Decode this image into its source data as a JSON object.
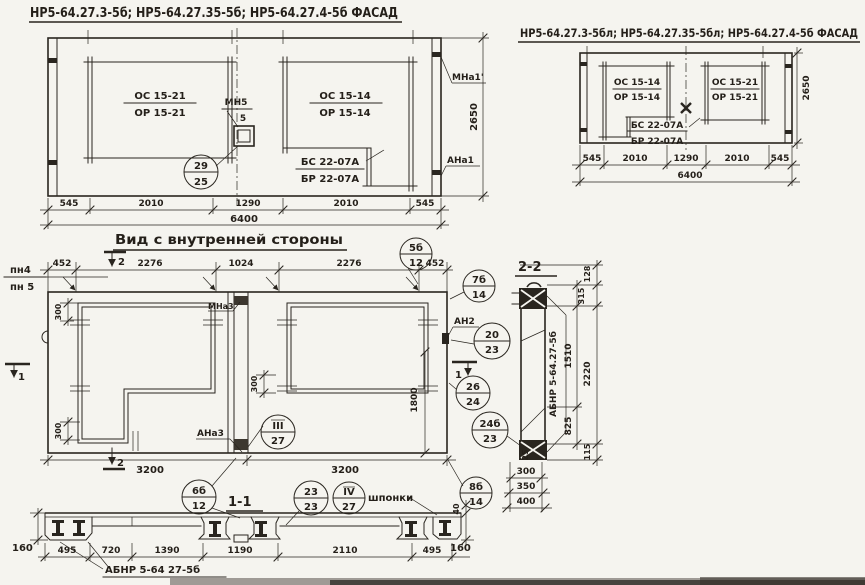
{
  "paper": {
    "bg": "#f5f4ef",
    "ink": "#29251f"
  },
  "facade_left": {
    "title": "НР5-64.27.3-5б; НР5-64.27.35-5б; НР5-64.27.4-5б   ФАСАД",
    "win_left": {
      "num": "ОС 15-21",
      "den": "ОР 15-21"
    },
    "win_right": {
      "num": "ОС 15-14",
      "den": "ОР 15-14"
    },
    "mid": {
      "num": "МН5",
      "den": "5"
    },
    "beam": {
      "num": "БС 22-07А",
      "den": "БР 22-07А"
    },
    "callout": {
      "num": "29",
      "den": "25"
    },
    "lbl_mna1": "МНа1'",
    "lbl_ana1": "АНа1",
    "dim_height": "2650",
    "dims": [
      "545",
      "2010",
      "1290",
      "2010",
      "545"
    ],
    "dim_total": "6400"
  },
  "facade_right": {
    "title": "НР5-64.27.3-5бл; НР5-64.27.35-5бл; НР5-64.27.4-5б ФАСАД",
    "win_left": {
      "num": "ОС 15-14",
      "den": "ОР 15-14"
    },
    "win_right": {
      "num": "ОС 15-21",
      "den": "ОР 15-21"
    },
    "beam": {
      "num": "БС 22-07А",
      "den": "БР 22-07А"
    },
    "dim_height": "2650",
    "dims": [
      "545",
      "2010",
      "1290",
      "2010",
      "545"
    ],
    "dim_total": "6400"
  },
  "inner": {
    "title": "Вид с внутренней стороны",
    "pn": {
      "num": "пн4",
      "den": "пн 5"
    },
    "top_dims": [
      "452",
      "2276",
      "1024",
      "2276",
      "452"
    ],
    "bottom_dims": [
      "3200",
      "3200"
    ],
    "sec2": "2",
    "sec1": "1",
    "lbl_mna3": "МНа3",
    "lbl_ana3": "АНа3",
    "lbl_an2": "АН2",
    "dim_300": "300",
    "dim_1800": "1800",
    "callouts": {
      "c5b": {
        "num": "5б",
        "den": "12"
      },
      "c7b": {
        "num": "7б",
        "den": "14"
      },
      "c20": {
        "num": "20",
        "den": "23"
      },
      "c26": {
        "num": "26",
        "den": "24"
      },
      "c24b": {
        "num": "24б",
        "den": "23"
      },
      "c8b": {
        "num": "8б",
        "den": "14"
      },
      "c3": {
        "num": "III",
        "den": "27"
      },
      "c6b": {
        "num": "6б",
        "den": "12"
      }
    }
  },
  "sec22": {
    "title": "2-2",
    "lbl": "АБНР 5-64.27-5б",
    "d128": "128",
    "d315": "315",
    "d1510": "1510",
    "d2220": "2220",
    "d825": "825",
    "d115": "115",
    "d25": "25",
    "stack": [
      "300",
      "350",
      "400"
    ]
  },
  "sec11": {
    "title": "1-1",
    "lbl": "АБНР 5-64 27-5б",
    "shponki": "шпонки",
    "callouts": {
      "c23": {
        "num": "23",
        "den": "23"
      },
      "c4": {
        "num": "IV",
        "den": "27"
      }
    },
    "dims": [
      "495",
      "720",
      "1390",
      "1190",
      "2110",
      "495"
    ],
    "d160l": "160",
    "d160r": "160",
    "d40": "40"
  }
}
